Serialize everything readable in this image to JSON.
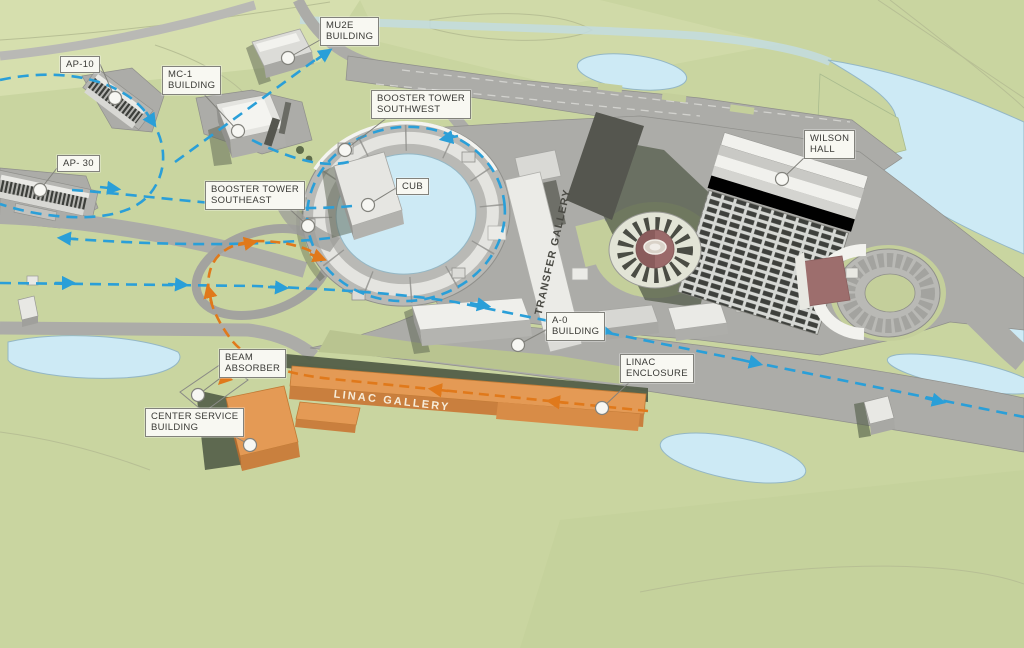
{
  "colors": {
    "grass": "#c9d5a0",
    "grassLight": "#dae2b6",
    "grassOlive": "#b9c490",
    "water": "#cdeaf5",
    "waterEdge": "#94b7c5",
    "road": "#acaca8",
    "roadEdge": "#8f8f8b",
    "roadLight": "#b9b9b5",
    "bldgTop": "#e9e9e5",
    "bldgSide": "#acacaa",
    "bldgDark": "#8f8f8d",
    "shadow": "#535c48",
    "beamBlue": "#2a9fd8",
    "beamOrange": "#e0791b",
    "orangeRoof": "#e49a55",
    "orangeFront": "#c97f3e",
    "orangeSide": "#b06c31",
    "mauve": "#9d6e6d",
    "labelBg": "#f8f8f2",
    "labelBorder": "#82827c",
    "labelText": "#3a3a36"
  },
  "callouts": [
    {
      "id": "ap-10",
      "lines": [
        "AP-10"
      ],
      "box": [
        60,
        56
      ],
      "marker": [
        115,
        98
      ],
      "leader": [
        [
          100,
          64
        ],
        [
          115,
          98
        ]
      ]
    },
    {
      "id": "ap-30",
      "lines": [
        "AP- 30"
      ],
      "box": [
        57,
        155
      ],
      "marker": [
        40,
        190
      ],
      "leader": [
        [
          57,
          168
        ],
        [
          40,
          190
        ]
      ]
    },
    {
      "id": "mc-1-building",
      "lines": [
        "MC-1",
        "BUILDING"
      ],
      "box": [
        162,
        66
      ],
      "marker": [
        238,
        131
      ],
      "leader": [
        [
          200,
          90
        ],
        [
          238,
          131
        ]
      ]
    },
    {
      "id": "mu2e-building",
      "lines": [
        "MU2E",
        "BUILDING"
      ],
      "box": [
        320,
        17
      ],
      "marker": [
        288,
        58
      ],
      "leader": [
        [
          320,
          40
        ],
        [
          288,
          58
        ]
      ]
    },
    {
      "id": "booster-tower-southwest",
      "lines": [
        "BOOSTER TOWER",
        "SOUTHWEST"
      ],
      "box": [
        371,
        90
      ],
      "marker": [
        345,
        150
      ],
      "leader": [
        [
          392,
          114
        ],
        [
          345,
          150
        ]
      ]
    },
    {
      "id": "booster-tower-southeast",
      "lines": [
        "BOOSTER TOWER",
        "SOUTHEAST"
      ],
      "box": [
        205,
        181
      ],
      "marker": [
        308,
        226
      ],
      "leader": [
        [
          283,
          203
        ],
        [
          308,
          226
        ]
      ]
    },
    {
      "id": "cub",
      "lines": [
        "CUB"
      ],
      "box": [
        396,
        178
      ],
      "marker": [
        368,
        205
      ],
      "leader": [
        [
          396,
          188
        ],
        [
          368,
          205
        ]
      ]
    },
    {
      "id": "wilson-hall",
      "lines": [
        "WILSON",
        "HALL"
      ],
      "box": [
        804,
        130
      ],
      "marker": [
        782,
        179
      ],
      "leader": [
        [
          806,
          156
        ],
        [
          782,
          179
        ]
      ]
    },
    {
      "id": "a-0-building",
      "lines": [
        "A-0",
        "BUILDING"
      ],
      "box": [
        546,
        312
      ],
      "marker": [
        518,
        345
      ],
      "leader": [
        [
          546,
          330
        ],
        [
          518,
          345
        ]
      ]
    },
    {
      "id": "linac-enclosure",
      "lines": [
        "LINAC",
        "ENCLOSURE"
      ],
      "box": [
        620,
        354
      ],
      "marker": [
        602,
        408
      ],
      "leader": [
        [
          634,
          378
        ],
        [
          602,
          408
        ]
      ]
    },
    {
      "id": "beam-absorber",
      "lines": [
        "BEAM",
        "ABSORBER"
      ],
      "box": [
        219,
        349
      ],
      "marker": [
        198,
        395
      ],
      "leader": [
        [
          227,
          373
        ],
        [
          198,
          395
        ]
      ]
    },
    {
      "id": "center-service-building",
      "lines": [
        "CENTER SERVICE",
        "BUILDING"
      ],
      "box": [
        145,
        408
      ],
      "marker": [
        250,
        445
      ],
      "leader": [
        [
          223,
          430
        ],
        [
          250,
          445
        ]
      ]
    }
  ],
  "surface_texts": [
    {
      "id": "linac-gallery-text",
      "text": "LINAC GALLERY",
      "x": 392,
      "y": 401,
      "rotate": 6.5,
      "cls": "gallery"
    },
    {
      "id": "transfer-gallery-text",
      "text": "TRANSFER GALLERY",
      "x": 553,
      "y": 252,
      "rotate": -77,
      "cls": "transfer"
    }
  ]
}
